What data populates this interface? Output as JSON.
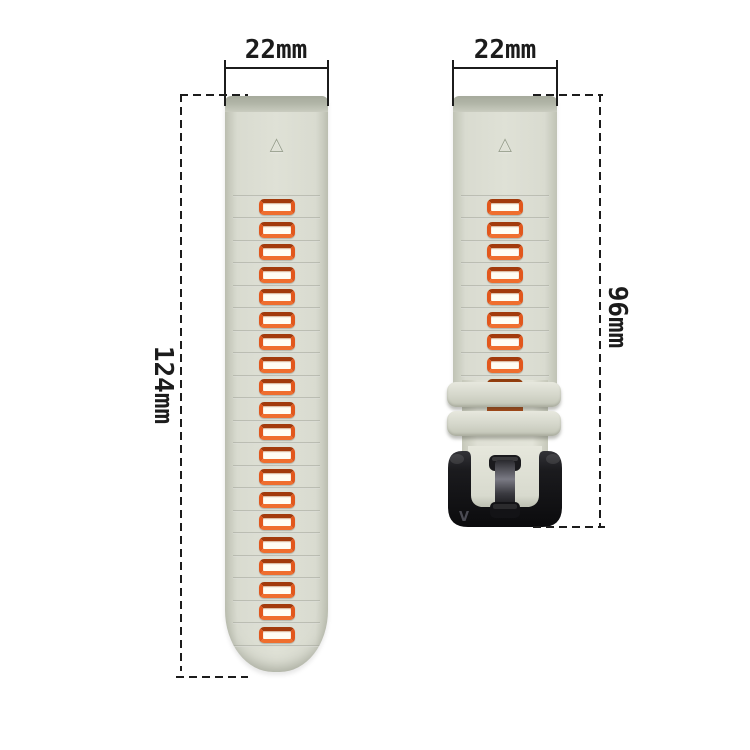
{
  "annotations": {
    "left_width_label": "22mm",
    "right_width_label": "22mm",
    "left_length_label": "124mm",
    "right_length_label": "96mm"
  },
  "straps": {
    "left": {
      "hole_count": 20,
      "groove_count": 21
    },
    "right": {
      "hole_count": 8,
      "groove_count": 9,
      "hidden_hole_count": 2,
      "keeper_count": 2
    }
  },
  "buckle": {
    "logo_text": "V"
  },
  "icons": {
    "triangle_logo_glyph": "△"
  },
  "colors": {
    "background": "#ffffff",
    "dimension_line": "#1c1c1c",
    "strap_base": "#d9dbd0",
    "strap_edge": "#c0c3b5",
    "strap_top_band": "#b1b5a7",
    "hole_orange": "#e2571c",
    "hole_orange_dark": "#a23a0c",
    "hole_inner": "#fffdf4",
    "hidden_hole": "#b04a16",
    "buckle_black": "#141416"
  }
}
